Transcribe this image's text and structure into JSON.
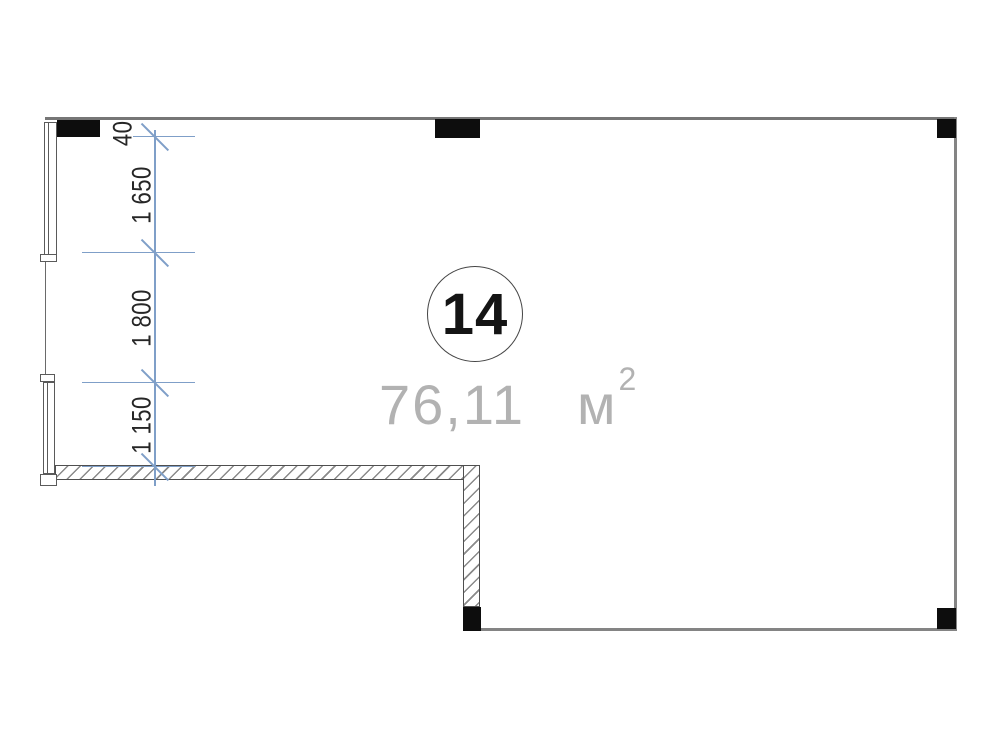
{
  "plan": {
    "unit": {
      "number": "14",
      "area_value": "76,11",
      "area_unit": "м",
      "area_exponent": "2"
    },
    "dimensions": {
      "labels": [
        "400",
        "1 650",
        "1 800",
        "1 150"
      ]
    },
    "colors": {
      "dimension_blue": "#7f9fc8",
      "wall_gray": "#848484",
      "column_fill": "#0d0d0d",
      "hatch_gray": "#8a8a8a",
      "area_text_gray": "#b2b2b2"
    }
  }
}
